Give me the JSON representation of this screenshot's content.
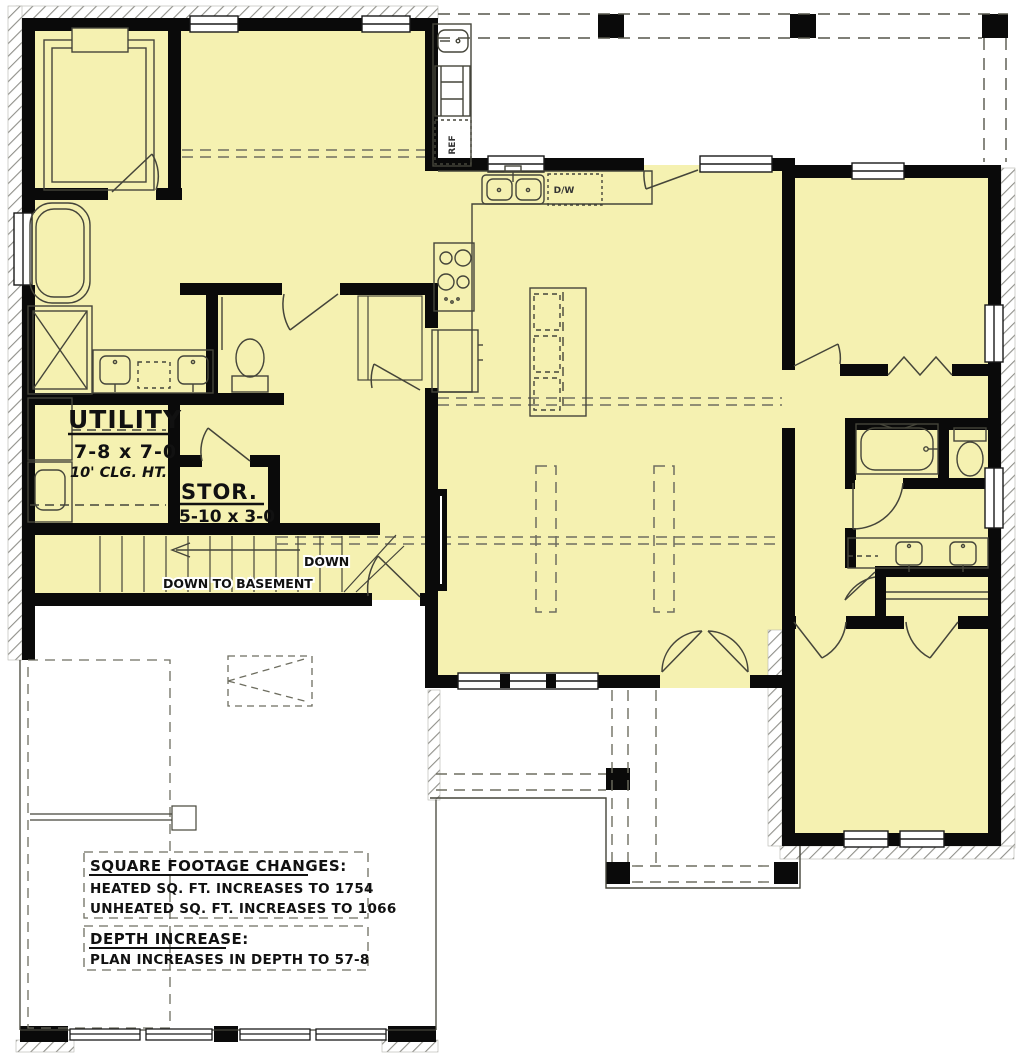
{
  "rooms": {
    "utility": {
      "name": "UTILITY",
      "dims": "7-8 x 7-0",
      "ceiling": "10' CLG. HT."
    },
    "storage": {
      "name": "STOR.",
      "dims": "5-10 x 3-0"
    }
  },
  "stairs": {
    "label": "DOWN TO BASEMENT",
    "down": "DOWN"
  },
  "appliances": {
    "dishwasher": "D/W",
    "refrigerator": "REF"
  },
  "notes": {
    "sqft_title": "SQUARE FOOTAGE CHANGES:",
    "sqft_line1": "HEATED SQ. FT. INCREASES TO 1754",
    "sqft_line2": "UNHEATED SQ. FT. INCREASES TO 1066",
    "depth_title": "DEPTH INCREASE:",
    "depth_line1": "PLAN INCREASES IN DEPTH TO 57-8"
  },
  "colors": {
    "heated_fill": "#F5F1B1",
    "wall": "#0A0A0A",
    "thin_line": "#45453A",
    "dashed_line": "#6E6E60",
    "hatch": "#90908A"
  }
}
